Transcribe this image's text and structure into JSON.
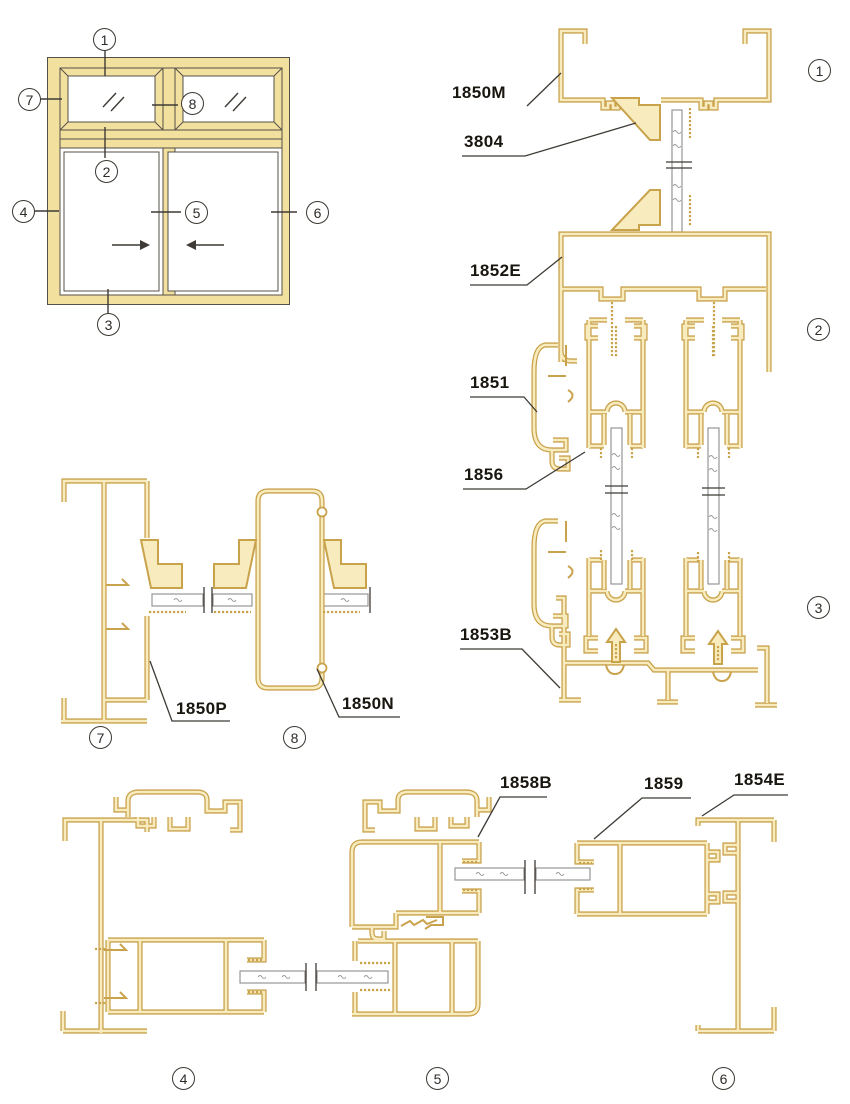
{
  "colors": {
    "profile_outline": "#C9A24C",
    "profile_core": "#F8ECBE",
    "elevation_fill": "#F2E09E",
    "dark_line": "#3E3A35",
    "glass_edge": "#8D8D8D"
  },
  "part_labels": {
    "p1850M": "1850M",
    "p3804": "3804",
    "p1852E": "1852E",
    "p1851": "1851",
    "p1856": "1856",
    "p1853B": "1853B",
    "p1850P": "1850P",
    "p1850N": "1850N",
    "p1858B": "1858B",
    "p1859": "1859",
    "p1854E": "1854E"
  },
  "callouts": {
    "elevation": [
      {
        "n": "1"
      },
      {
        "n": "7"
      },
      {
        "n": "8"
      },
      {
        "n": "2"
      },
      {
        "n": "4"
      },
      {
        "n": "5"
      },
      {
        "n": "6"
      },
      {
        "n": "3"
      }
    ],
    "right_column": [
      {
        "n": "1"
      },
      {
        "n": "2"
      },
      {
        "n": "3"
      }
    ],
    "middle_row": [
      {
        "n": "7"
      },
      {
        "n": "8"
      }
    ],
    "bottom_row": [
      {
        "n": "4"
      },
      {
        "n": "5"
      },
      {
        "n": "6"
      }
    ]
  }
}
